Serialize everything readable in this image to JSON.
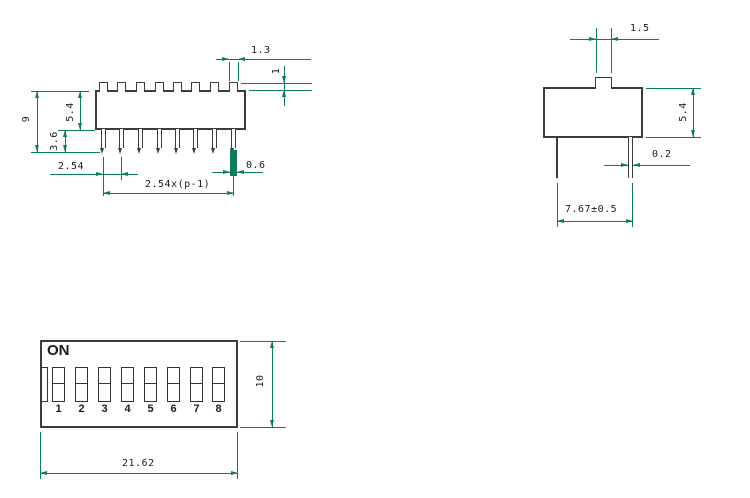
{
  "colors": {
    "background": "#ffffff",
    "part_outline": "#3c3c3c",
    "dimension_lines": "#0c7b60",
    "dimension_text": "#1c1c1c"
  },
  "front_view": {
    "dim_actuator_width": "1.3",
    "dim_actuator_height": "1",
    "dim_body_height": "5.4",
    "dim_total_height": "9",
    "dim_pin_length": "3.6",
    "dim_pin_pitch": "2.54",
    "dim_pin_row_span": "2.54x(p-1)",
    "dim_pin_width": "0.6"
  },
  "side_view": {
    "dim_actuator_width": "1.5",
    "dim_body_height": "5.4",
    "dim_pin_thickness": "0.2",
    "dim_pin_spacing": "7.67±0.5"
  },
  "top_view": {
    "on_label": "ON",
    "position_labels": [
      "1",
      "2",
      "3",
      "4",
      "5",
      "6",
      "7",
      "8"
    ],
    "dim_body_length": "21.62",
    "dim_body_width": "10"
  }
}
